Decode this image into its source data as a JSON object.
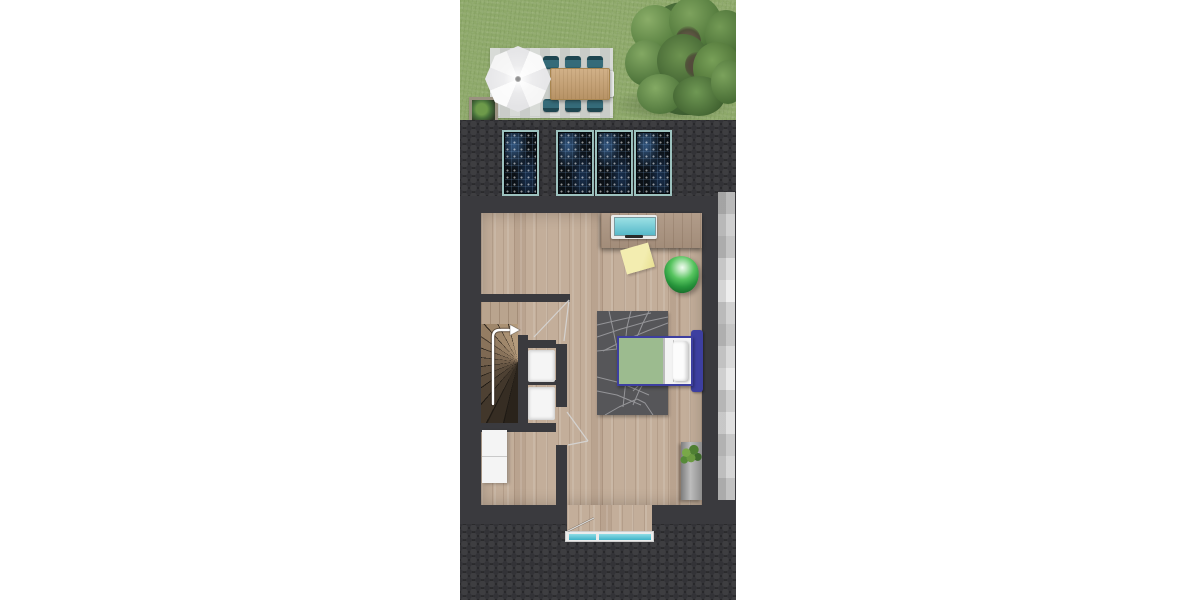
{
  "scene": {
    "type": "architectural-floor-plan-top-view",
    "description": "Top-down 3D rendered floor plan of a narrow house attic level with garden at top",
    "sections": [
      {
        "name": "garden",
        "objects": [
          "lawn",
          "patio",
          "parasol-umbrella",
          "dining-table",
          "six-teal-chairs",
          "end-bench",
          "patio-planter",
          "large-tree"
        ]
      },
      {
        "name": "front-roof",
        "objects": [
          "dark-shingle-roof",
          "four-solar-panels"
        ]
      },
      {
        "name": "interior",
        "objects": [
          "wood-floor",
          "desk",
          "laptop",
          "paper-note",
          "green-beanbag",
          "gray-area-rug",
          "single-bed-blue-frame-green-mattress",
          "winder-staircase",
          "up-direction-arrow",
          "two-white-fixtures",
          "storage-cabinet",
          "tall-planter-with-plant",
          "door-swings"
        ]
      },
      {
        "name": "side-roof-plane",
        "objects": [
          "gray-banded-roof-strip"
        ]
      },
      {
        "name": "entry-bay",
        "objects": [
          "bay-floor",
          "entry-door-window-teal"
        ]
      },
      {
        "name": "rear-roof",
        "objects": [
          "dark-shingle-roof"
        ]
      }
    ]
  },
  "palette": {
    "grass": "#8ea96a",
    "patio-a": "#d8dbd7",
    "patio-b": "#c9ccc8",
    "table-wood": "#c79f6e",
    "chair-teal": "#2e5f6d",
    "umbrella-a": "#fafafa",
    "umbrella-b": "#e7e7e9",
    "tree-a": "#6f9553",
    "tree-b": "#3a5a2e",
    "tile-base": "#232325",
    "tile-circle-a": "#3e3e41",
    "tile-circle-b": "#333337",
    "panel-frame": "#9dc2bf",
    "panel-base": "#0b1015",
    "wall": "#3a3a3e",
    "floor-a": "#c3ae9a",
    "desk": "#ab9480",
    "laptop-screen": "#57b9ca",
    "note": "#f3edb0",
    "beanbag": "#27953b",
    "rug": "#565659",
    "rug-line": "#a0a0a4",
    "bed-blue": "#3d3fa0",
    "mattress": "#9cbb8f",
    "bedding": "#f3f3f3",
    "stair-light": "#b49b7c",
    "stair-dark": "#2a231b",
    "fixture": "#f5f5f5",
    "window-teal": "#3fb3c8",
    "strip-gray": "#c6c6c6",
    "planter-gray": "#9a9a9a",
    "plant-green": "#5d8f3f",
    "arrow-white": "#ffffff"
  }
}
